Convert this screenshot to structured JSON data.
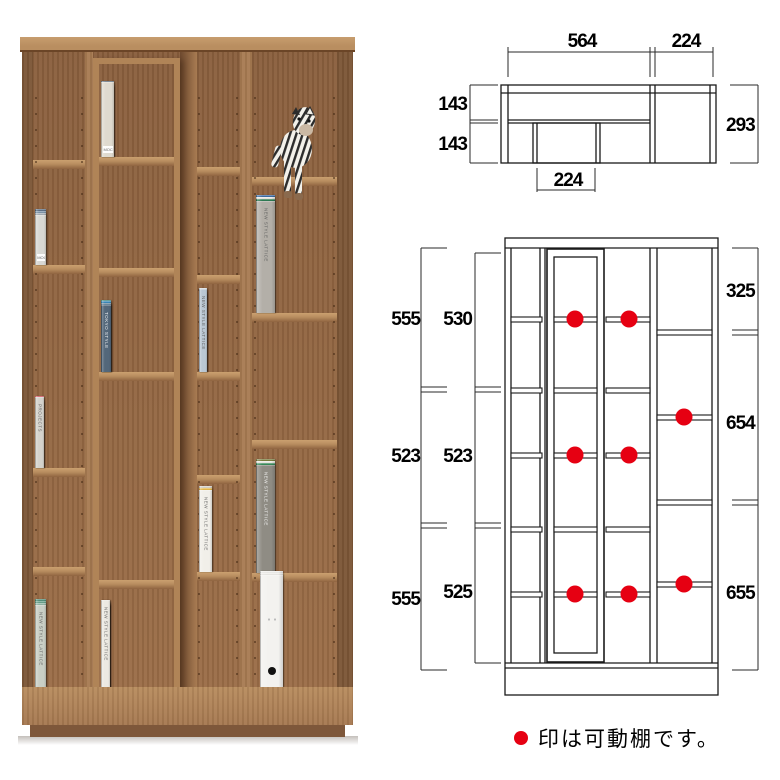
{
  "colors": {
    "marker": "#e60012",
    "line": "#1a1a1a",
    "wood_accent": "#a0714a"
  },
  "top_view": {
    "width_main": "564",
    "width_side_col": "224",
    "depth_back": "143",
    "depth_front": "143",
    "depth_total": "293",
    "slider_width": "224"
  },
  "front_view": {
    "outer_heights": [
      "555",
      "523",
      "555"
    ],
    "inner_heights": [
      "530",
      "523",
      "525"
    ],
    "right_heights": [
      "325",
      "654",
      "655"
    ]
  },
  "legend": {
    "text": "印は可動棚です。"
  },
  "photo": {
    "colors": {
      "crown": "#b98e60",
      "crown_dark": "#6b4527",
      "side": "#7c5636",
      "interior": "#9b6d47",
      "interior_dark": "#8a5f3d",
      "divider": "#a87b52",
      "recess": "#6e4a2f",
      "shelf": "#b98e60",
      "unit": "#b08457",
      "base": "#a67850",
      "plinth": "#7e573a"
    },
    "walls": [
      {
        "x": 2,
        "w": 11,
        "c": "side"
      },
      {
        "x": 65,
        "w": 8,
        "c": "divider"
      },
      {
        "x": 220,
        "w": 12,
        "c": "divider"
      },
      {
        "x": 317,
        "w": 16,
        "c": "side"
      }
    ],
    "recess": {
      "x": 160,
      "w": 17
    },
    "columns": [
      {
        "x": 13,
        "w": 52,
        "shelves": [
          123,
          228,
          431,
          530
        ]
      },
      {
        "x": 177,
        "w": 43,
        "shelves": [
          130,
          238,
          335,
          438,
          535
        ]
      },
      {
        "x": 232,
        "w": 85,
        "shelves": [
          140,
          276,
          403,
          536
        ]
      }
    ],
    "unit": {
      "x": 73,
      "w": 87,
      "y": 21,
      "h": 640,
      "wall": 6,
      "shelves": [
        120,
        231,
        335,
        543
      ]
    },
    "books": [
      {
        "x": 15,
        "bottom": 228,
        "h": 58,
        "w": 11,
        "gap": 1,
        "style": "band",
        "label": "MOCO",
        "items": [
          "#5f7186",
          "#7e95ab",
          "#a8b0b8",
          "#d8d8d4"
        ]
      },
      {
        "x": 15,
        "bottom": 431,
        "h": 74,
        "w": 9,
        "gap": 1,
        "style": "v",
        "label": "PROJECTS",
        "items": [
          "#d84a58",
          "#e8707a",
          "#efede8",
          "#44997b",
          "#d5d3cd"
        ]
      },
      {
        "x": 15,
        "bottom": 650,
        "h": 90,
        "w": 11,
        "gap": 1,
        "style": "v",
        "label": "NEW STYLE LATTICE",
        "items": [
          "#55917b",
          "#69a28c",
          "#93b8a6",
          "#c9cfc5"
        ]
      },
      {
        "x": 81,
        "bottom": 120,
        "h": 78,
        "w": 13,
        "gap": 1,
        "style": "band",
        "label": "MOCO",
        "unit": true,
        "items": [
          "#5a6b7c",
          "#92b6ce",
          "#8d9cab",
          "#ebe8e3",
          "#dfdacf"
        ]
      },
      {
        "x": 81,
        "bottom": 335,
        "h": 74,
        "w": 10,
        "gap": 0,
        "style": "v",
        "label": "TOKYO STYLE",
        "unit": true,
        "items": [
          "#3d8a80",
          "#2fb096",
          "#28a49c",
          "#45b2d4",
          "#3a89ba",
          "#6f8ba0",
          "#53677a"
        ]
      },
      {
        "x": 81,
        "bottom": 655,
        "h": 94,
        "w": 9,
        "gap": 0,
        "style": "v",
        "label": "NEW STYLE LATTICE",
        "unit": true,
        "items": [
          "#4c8f6f",
          "#8fae9a",
          "#e0584a",
          "#e8c25a",
          "#7fb3d6",
          "#4a79b0",
          "#b9855a",
          "#ece9e2"
        ]
      },
      {
        "x": 179,
        "bottom": 335,
        "h": 86,
        "w": 8,
        "gap": 0,
        "style": "v",
        "label": "NEW STYLE LATTICE",
        "items": [
          "#e2e6e9",
          "#a6c6e0",
          "#c8d8e7",
          "#eff1f2",
          "#bac7d3"
        ]
      },
      {
        "x": 179,
        "bottom": 535,
        "h": 88,
        "w": 13,
        "gap": 1,
        "style": "v",
        "label": "NEW STYLE LATTICE",
        "items": [
          "#d8d4ca",
          "#e9bb4e",
          "#f1efe9"
        ]
      },
      {
        "x": 236,
        "bottom": 276,
        "h": 120,
        "w": 19,
        "gap": 1,
        "style": "v",
        "label": "NEW STYLE LATTICE",
        "items": [
          "#3f6ea5",
          "#ece9e3",
          "#2e7d54",
          "#b3afa8"
        ]
      },
      {
        "x": 236,
        "bottom": 536,
        "h": 116,
        "w": 19,
        "gap": 1,
        "style": "v",
        "label": "NEW STYLE LATTICE",
        "items": [
          "#7a7f3f",
          "#eceae4",
          "#3a8c5c",
          "#8f8c84"
        ]
      },
      {
        "x": 240,
        "bottom": 650,
        "h": 116,
        "w": 23,
        "gap": 2,
        "style": "binder",
        "label": "",
        "items": [
          "#f1f0ed",
          "#eeede9",
          "#f3f2ef"
        ]
      }
    ],
    "zebra": {
      "x": 248,
      "y": 64,
      "w": 60,
      "h": 102
    }
  }
}
